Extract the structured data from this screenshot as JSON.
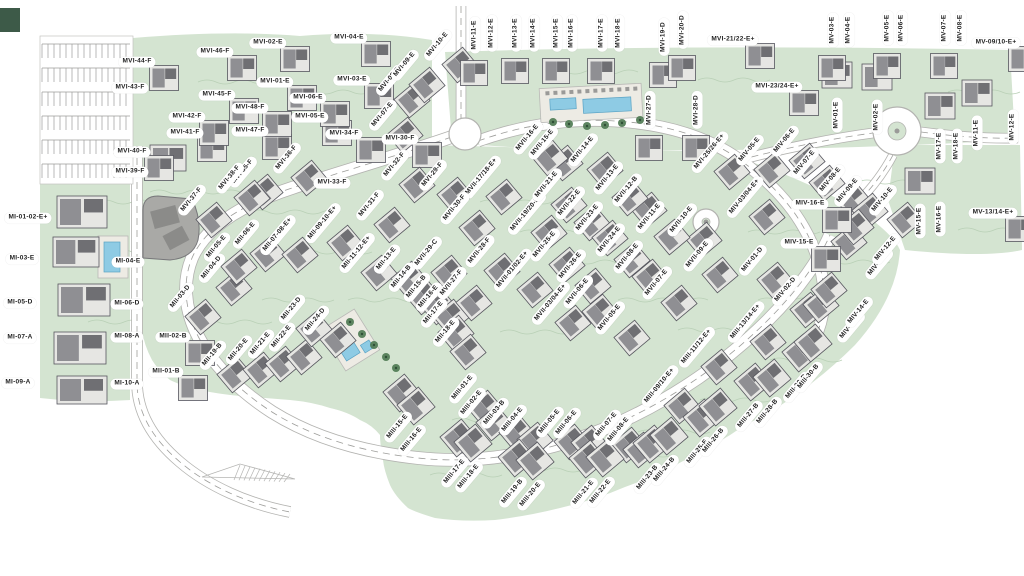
{
  "map": {
    "type": "residential-master-plan",
    "colors": {
      "background": "#ffffff",
      "terrain": "#d4e4d1",
      "contour": "#b9d0b6",
      "road_fill": "#ffffff",
      "road_casing": "#b3b3b0",
      "road_dash": "#9d9d9a",
      "building_fill": "#e6e6e3",
      "building_stroke": "#56565e",
      "building_core": "#8f8f93",
      "building_dark": "#6f6f73",
      "deck": "#edebe4",
      "pool": "#8ecbe4",
      "pool_stroke": "#5ba3c4",
      "tree": "#4f7b54",
      "clubhouse": "#a9a9a6",
      "label_bg": "#ffffff",
      "label_text": "#1e1e1e"
    },
    "labels": [
      {
        "t": "MI-01-02-E+",
        "x": 28,
        "y": 218,
        "o": "h"
      },
      {
        "t": "MI-03-E",
        "x": 22,
        "y": 259,
        "o": "h"
      },
      {
        "t": "MI-04-E",
        "x": 128,
        "y": 262,
        "o": "h"
      },
      {
        "t": "MI-05-D",
        "x": 20,
        "y": 303,
        "o": "h"
      },
      {
        "t": "MI-06-D",
        "x": 127,
        "y": 304,
        "o": "h"
      },
      {
        "t": "MI-07-A",
        "x": 20,
        "y": 338,
        "o": "h"
      },
      {
        "t": "MI-08-A",
        "x": 127,
        "y": 337,
        "o": "h"
      },
      {
        "t": "MI-09-A",
        "x": 18,
        "y": 383,
        "o": "h"
      },
      {
        "t": "MI-10-A",
        "x": 127,
        "y": 384,
        "o": "h"
      },
      {
        "t": "MII-01-B",
        "x": 166,
        "y": 372,
        "o": "h"
      },
      {
        "t": "MII-02-B",
        "x": 173,
        "y": 337,
        "o": "h"
      },
      {
        "t": "MII-03-D",
        "x": 181,
        "y": 297,
        "o": "d"
      },
      {
        "t": "MII-04-D",
        "x": 212,
        "y": 268,
        "o": "d"
      },
      {
        "t": "MII-05-E",
        "x": 217,
        "y": 247,
        "o": "d"
      },
      {
        "t": "MII-06-E",
        "x": 246,
        "y": 234,
        "o": "d"
      },
      {
        "t": "MII-07-08-E+",
        "x": 278,
        "y": 235,
        "o": "d"
      },
      {
        "t": "MII-09-10-E+",
        "x": 323,
        "y": 223,
        "o": "d"
      },
      {
        "t": "MII-11-12-E+",
        "x": 357,
        "y": 253,
        "o": "d"
      },
      {
        "t": "MII-13-E",
        "x": 387,
        "y": 259,
        "o": "d"
      },
      {
        "t": "MII-14-B",
        "x": 402,
        "y": 277,
        "o": "d"
      },
      {
        "t": "MII-15-B",
        "x": 417,
        "y": 287,
        "o": "d"
      },
      {
        "t": "MII-16-E",
        "x": 429,
        "y": 297,
        "o": "d"
      },
      {
        "t": "MII-17-E",
        "x": 434,
        "y": 313,
        "o": "d"
      },
      {
        "t": "MII-18-E",
        "x": 446,
        "y": 332,
        "o": "d"
      },
      {
        "t": "MII-19-B",
        "x": 213,
        "y": 355,
        "o": "d"
      },
      {
        "t": "MII-20-E",
        "x": 239,
        "y": 350,
        "o": "d"
      },
      {
        "t": "MII-21-E",
        "x": 261,
        "y": 344,
        "o": "d"
      },
      {
        "t": "MII-22-E",
        "x": 282,
        "y": 337,
        "o": "d"
      },
      {
        "t": "MII-23-D",
        "x": 292,
        "y": 309,
        "o": "d"
      },
      {
        "t": "MII-24-D",
        "x": 316,
        "y": 320,
        "o": "d"
      },
      {
        "t": "MIII-01-E",
        "x": 463,
        "y": 388,
        "o": "d"
      },
      {
        "t": "MIII-02-E",
        "x": 472,
        "y": 403,
        "o": "d"
      },
      {
        "t": "MIII-03-B",
        "x": 495,
        "y": 413,
        "o": "d"
      },
      {
        "t": "MIII-04-E",
        "x": 513,
        "y": 420,
        "o": "d"
      },
      {
        "t": "MIII-05-E",
        "x": 550,
        "y": 422,
        "o": "d"
      },
      {
        "t": "MIII-06-E",
        "x": 567,
        "y": 423,
        "o": "d"
      },
      {
        "t": "MIII-07-E",
        "x": 607,
        "y": 425,
        "o": "d"
      },
      {
        "t": "MIII-08-E",
        "x": 619,
        "y": 430,
        "o": "d"
      },
      {
        "t": "MIII-09/10-E+",
        "x": 660,
        "y": 386,
        "o": "d"
      },
      {
        "t": "MIII-11/12-E+",
        "x": 697,
        "y": 347,
        "o": "d"
      },
      {
        "t": "MIII-13/14-E+",
        "x": 746,
        "y": 322,
        "o": "d"
      },
      {
        "t": "MIII-15-E",
        "x": 398,
        "y": 427,
        "o": "d"
      },
      {
        "t": "MIII-16-E",
        "x": 412,
        "y": 440,
        "o": "d"
      },
      {
        "t": "MIII-17-E",
        "x": 455,
        "y": 472,
        "o": "d"
      },
      {
        "t": "MIII-18-E",
        "x": 469,
        "y": 477,
        "o": "d"
      },
      {
        "t": "MIII-19-B",
        "x": 513,
        "y": 492,
        "o": "d"
      },
      {
        "t": "MIII-20-E",
        "x": 531,
        "y": 495,
        "o": "d"
      },
      {
        "t": "MIII-21-E",
        "x": 584,
        "y": 493,
        "o": "d"
      },
      {
        "t": "MIII-22-E",
        "x": 601,
        "y": 492,
        "o": "d"
      },
      {
        "t": "MIII-23-B",
        "x": 648,
        "y": 478,
        "o": "d"
      },
      {
        "t": "MIII-24-B",
        "x": 665,
        "y": 470,
        "o": "d"
      },
      {
        "t": "MIII-25-E",
        "x": 698,
        "y": 452,
        "o": "d"
      },
      {
        "t": "MIII-26-B",
        "x": 714,
        "y": 441,
        "o": "d"
      },
      {
        "t": "MIII-27-B",
        "x": 749,
        "y": 416,
        "o": "d"
      },
      {
        "t": "MIII-28-B",
        "x": 768,
        "y": 412,
        "o": "d"
      },
      {
        "t": "MIII-29-B",
        "x": 797,
        "y": 387,
        "o": "d"
      },
      {
        "t": "MIII-30-B",
        "x": 809,
        "y": 377,
        "o": "d"
      },
      {
        "t": "MIV-01-D",
        "x": 753,
        "y": 260,
        "o": "d"
      },
      {
        "t": "MIV-02-D",
        "x": 786,
        "y": 290,
        "o": "d"
      },
      {
        "t": "MIV-03/04-E+",
        "x": 745,
        "y": 197,
        "o": "d"
      },
      {
        "t": "MIV-05-E",
        "x": 750,
        "y": 150,
        "o": "d"
      },
      {
        "t": "MIV-06-E",
        "x": 785,
        "y": 141,
        "o": "d"
      },
      {
        "t": "MIV-07-E",
        "x": 805,
        "y": 163,
        "o": "d"
      },
      {
        "t": "MIV-08-E",
        "x": 831,
        "y": 180,
        "o": "d"
      },
      {
        "t": "MIV-09-E",
        "x": 848,
        "y": 191,
        "o": "d"
      },
      {
        "t": "MIV-10-E",
        "x": 883,
        "y": 200,
        "o": "d"
      },
      {
        "t": "MIV-11-E",
        "x": 879,
        "y": 264,
        "o": "d"
      },
      {
        "t": "MIV-12-E",
        "x": 886,
        "y": 249,
        "o": "d"
      },
      {
        "t": "MIV-13-E",
        "x": 851,
        "y": 327,
        "o": "d"
      },
      {
        "t": "MIV-14-E",
        "x": 859,
        "y": 312,
        "o": "d"
      },
      {
        "t": "MIV-15-E",
        "x": 799,
        "y": 243,
        "o": "h"
      },
      {
        "t": "MIV-16-E",
        "x": 810,
        "y": 204,
        "o": "h"
      },
      {
        "t": "MV-01-E",
        "x": 837,
        "y": 115,
        "o": "v"
      },
      {
        "t": "MV-02-E",
        "x": 877,
        "y": 117,
        "o": "v"
      },
      {
        "t": "MV-03-E",
        "x": 833,
        "y": 30,
        "o": "v"
      },
      {
        "t": "MV-04-E",
        "x": 849,
        "y": 30,
        "o": "v"
      },
      {
        "t": "MV-05-E",
        "x": 888,
        "y": 28,
        "o": "v"
      },
      {
        "t": "MV-06-E",
        "x": 902,
        "y": 28,
        "o": "v"
      },
      {
        "t": "MV-07-E",
        "x": 945,
        "y": 28,
        "o": "v"
      },
      {
        "t": "MV-08-E",
        "x": 961,
        "y": 28,
        "o": "v"
      },
      {
        "t": "MV-09/10-E+",
        "x": 996,
        "y": 43,
        "o": "h"
      },
      {
        "t": "MV-11-E",
        "x": 977,
        "y": 133,
        "o": "v"
      },
      {
        "t": "MV-12-E",
        "x": 1013,
        "y": 127,
        "o": "v"
      },
      {
        "t": "MV-13/14-E+",
        "x": 993,
        "y": 213,
        "o": "h"
      },
      {
        "t": "MV-15-E",
        "x": 920,
        "y": 221,
        "o": "v"
      },
      {
        "t": "MV-16-E",
        "x": 940,
        "y": 219,
        "o": "v"
      },
      {
        "t": "MV-17-E",
        "x": 940,
        "y": 146,
        "o": "v"
      },
      {
        "t": "MV-18-E",
        "x": 957,
        "y": 146,
        "o": "v"
      },
      {
        "t": "MVI-01-E",
        "x": 275,
        "y": 82,
        "o": "h"
      },
      {
        "t": "MVI-02-E",
        "x": 268,
        "y": 43,
        "o": "h"
      },
      {
        "t": "MVI-03-E",
        "x": 352,
        "y": 80,
        "o": "h"
      },
      {
        "t": "MVI-04-E",
        "x": 349,
        "y": 38,
        "o": "h"
      },
      {
        "t": "MVI-05-E",
        "x": 310,
        "y": 117,
        "o": "h"
      },
      {
        "t": "MVI-06-E",
        "x": 308,
        "y": 98,
        "o": "h"
      },
      {
        "t": "MVI-07-E",
        "x": 383,
        "y": 115,
        "o": "d"
      },
      {
        "t": "MVI-08-E",
        "x": 390,
        "y": 80,
        "o": "d"
      },
      {
        "t": "MVI-09-E",
        "x": 405,
        "y": 65,
        "o": "d"
      },
      {
        "t": "MVI-10-E",
        "x": 438,
        "y": 45,
        "o": "d"
      },
      {
        "t": "MVI-11-E",
        "x": 475,
        "y": 35,
        "o": "v"
      },
      {
        "t": "MVI-12-E",
        "x": 492,
        "y": 33,
        "o": "v"
      },
      {
        "t": "MVI-13-E",
        "x": 516,
        "y": 33,
        "o": "v"
      },
      {
        "t": "MVI-14-E",
        "x": 534,
        "y": 33,
        "o": "v"
      },
      {
        "t": "MVI-15-E",
        "x": 557,
        "y": 33,
        "o": "v"
      },
      {
        "t": "MVI-16-E",
        "x": 572,
        "y": 33,
        "o": "v"
      },
      {
        "t": "MVI-17-E",
        "x": 602,
        "y": 33,
        "o": "v"
      },
      {
        "t": "MVI-18-E",
        "x": 619,
        "y": 33,
        "o": "v"
      },
      {
        "t": "MVI-19-D",
        "x": 664,
        "y": 37,
        "o": "v"
      },
      {
        "t": "MVI-20-D",
        "x": 683,
        "y": 30,
        "o": "v"
      },
      {
        "t": "MVI-21/22-E+",
        "x": 733,
        "y": 40,
        "o": "h"
      },
      {
        "t": "MVI-23/24-E+",
        "x": 777,
        "y": 87,
        "o": "h"
      },
      {
        "t": "MVI-25/26-E+",
        "x": 710,
        "y": 152,
        "o": "d"
      },
      {
        "t": "MVI-27-D",
        "x": 650,
        "y": 110,
        "o": "v"
      },
      {
        "t": "MVI-28-D",
        "x": 697,
        "y": 110,
        "o": "v"
      },
      {
        "t": "MVI-29-F",
        "x": 433,
        "y": 175,
        "o": "d"
      },
      {
        "t": "MVI-30-F",
        "x": 400,
        "y": 139,
        "o": "h"
      },
      {
        "t": "MVI-31-F",
        "x": 370,
        "y": 205,
        "o": "d"
      },
      {
        "t": "MVI-32-F",
        "x": 395,
        "y": 165,
        "o": "d"
      },
      {
        "t": "MVI-33-F",
        "x": 332,
        "y": 183,
        "o": "h"
      },
      {
        "t": "MVI-34-F",
        "x": 344,
        "y": 134,
        "o": "h"
      },
      {
        "t": "MVI-35-F",
        "x": 243,
        "y": 172,
        "o": "d"
      },
      {
        "t": "MVI-36-F",
        "x": 287,
        "y": 158,
        "o": "d"
      },
      {
        "t": "MVI-37-F",
        "x": 192,
        "y": 200,
        "o": "d"
      },
      {
        "t": "MVI-38-F",
        "x": 230,
        "y": 178,
        "o": "d"
      },
      {
        "t": "MVI-39-F",
        "x": 130,
        "y": 172,
        "o": "h"
      },
      {
        "t": "MVI-40-F",
        "x": 132,
        "y": 152,
        "o": "h"
      },
      {
        "t": "MVI-41-F",
        "x": 185,
        "y": 133,
        "o": "h"
      },
      {
        "t": "MVI-42-F",
        "x": 187,
        "y": 117,
        "o": "h"
      },
      {
        "t": "MVI-43-F",
        "x": 130,
        "y": 88,
        "o": "h"
      },
      {
        "t": "MVI-44-F",
        "x": 137,
        "y": 62,
        "o": "h"
      },
      {
        "t": "MVI-45-F",
        "x": 217,
        "y": 95,
        "o": "h"
      },
      {
        "t": "MVI-46-F",
        "x": 215,
        "y": 52,
        "o": "h"
      },
      {
        "t": "MVI-47-F",
        "x": 250,
        "y": 131,
        "o": "h"
      },
      {
        "t": "MVI-48-F",
        "x": 250,
        "y": 108,
        "o": "h"
      },
      {
        "t": "MVII-01/02-E+",
        "x": 513,
        "y": 270,
        "o": "d"
      },
      {
        "t": "MVII-03/04-E+",
        "x": 551,
        "y": 303,
        "o": "d"
      },
      {
        "t": "MVII-05-E",
        "x": 610,
        "y": 318,
        "o": "d"
      },
      {
        "t": "MVII-06-E",
        "x": 578,
        "y": 292,
        "o": "d"
      },
      {
        "t": "MVII-07-E",
        "x": 657,
        "y": 283,
        "o": "d"
      },
      {
        "t": "MVII-08-E",
        "x": 628,
        "y": 257,
        "o": "d"
      },
      {
        "t": "MVII-09-E",
        "x": 698,
        "y": 255,
        "o": "d"
      },
      {
        "t": "MVII-10-E",
        "x": 682,
        "y": 220,
        "o": "d"
      },
      {
        "t": "MVII-11-E",
        "x": 650,
        "y": 217,
        "o": "d"
      },
      {
        "t": "MVII-12-B",
        "x": 627,
        "y": 190,
        "o": "d"
      },
      {
        "t": "MVII-13-E",
        "x": 608,
        "y": 178,
        "o": "d"
      },
      {
        "t": "MVII-14-E",
        "x": 583,
        "y": 150,
        "o": "d"
      },
      {
        "t": "MVII-15-E",
        "x": 543,
        "y": 143,
        "o": "d"
      },
      {
        "t": "MVII-16-E",
        "x": 528,
        "y": 138,
        "o": "d"
      },
      {
        "t": "MVII-17/18-E+",
        "x": 482,
        "y": 177,
        "o": "d"
      },
      {
        "t": "MVII-19/20-E+",
        "x": 527,
        "y": 213,
        "o": "d"
      },
      {
        "t": "MVII-21-E",
        "x": 547,
        "y": 185,
        "o": "d"
      },
      {
        "t": "MVII-22-E",
        "x": 570,
        "y": 203,
        "o": "d"
      },
      {
        "t": "MVII-23-E",
        "x": 588,
        "y": 218,
        "o": "d"
      },
      {
        "t": "MVII-24-E",
        "x": 610,
        "y": 240,
        "o": "d"
      },
      {
        "t": "MVII-25-E",
        "x": 545,
        "y": 245,
        "o": "d"
      },
      {
        "t": "MVII-26-E",
        "x": 571,
        "y": 266,
        "o": "d"
      },
      {
        "t": "MVII-27-F",
        "x": 452,
        "y": 283,
        "o": "d"
      },
      {
        "t": "MVII-28-F",
        "x": 480,
        "y": 251,
        "o": "d"
      },
      {
        "t": "MVII-29-C",
        "x": 427,
        "y": 253,
        "o": "d"
      },
      {
        "t": "MVII-30-F",
        "x": 455,
        "y": 208,
        "o": "d"
      }
    ]
  }
}
